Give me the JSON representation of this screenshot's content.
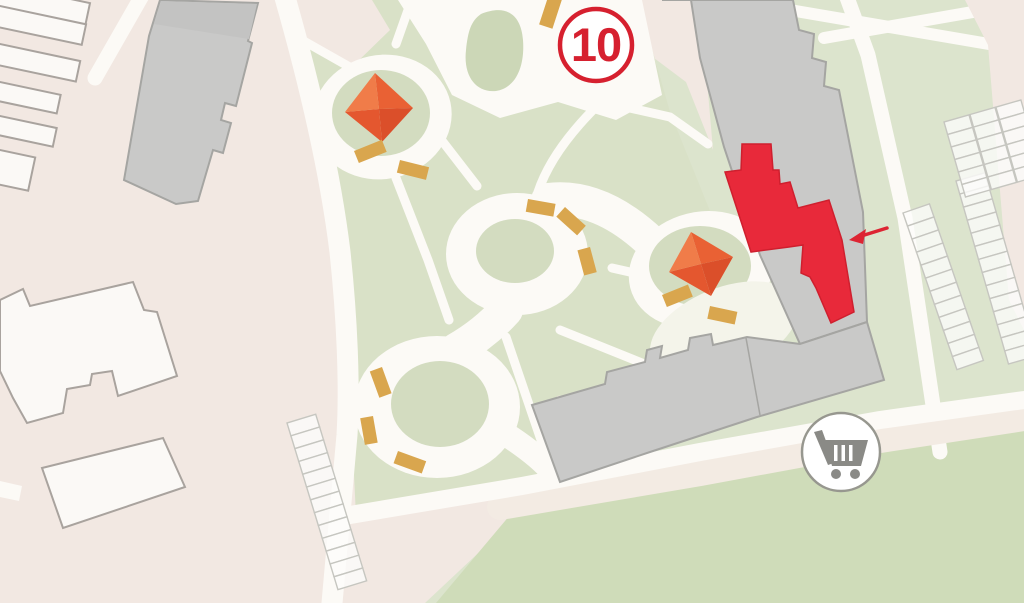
{
  "map": {
    "kind": "residential-complex-site-plan",
    "badge": {
      "label": "10"
    },
    "markers": {
      "highlighted_building": "building marked red, indicated by arrow",
      "cart": "shopping-cart location marker"
    },
    "features": {
      "playground_canopies": 2,
      "parking_rows": 4
    }
  },
  "colors": {
    "background_pink": "#f2e8e2",
    "road_white": "#fcfaf6",
    "park_green": "#d9e1c7",
    "island_green": "#ccd7b7",
    "right_green": "#dce4cd",
    "lawn_dark_green": "#cfdcb9",
    "road_pink_band": "#f3ebe3",
    "building_gray": "#c9c9c8",
    "building_white": "#fbf9f6",
    "highlight_red": "#e8293a",
    "badge_red": "#d6202f",
    "canopy_ne": "#e96134",
    "canopy_nw": "#f07c49",
    "canopy_se": "#db4f2a",
    "canopy_sw": "#e4572f",
    "bench_tan": "#d9a64e",
    "cart_gray": "#8a8a86",
    "arrow_red": "#dd2433"
  },
  "icons": {
    "cart": "shopping-cart-icon",
    "arrow": "left-arrow-icon"
  }
}
